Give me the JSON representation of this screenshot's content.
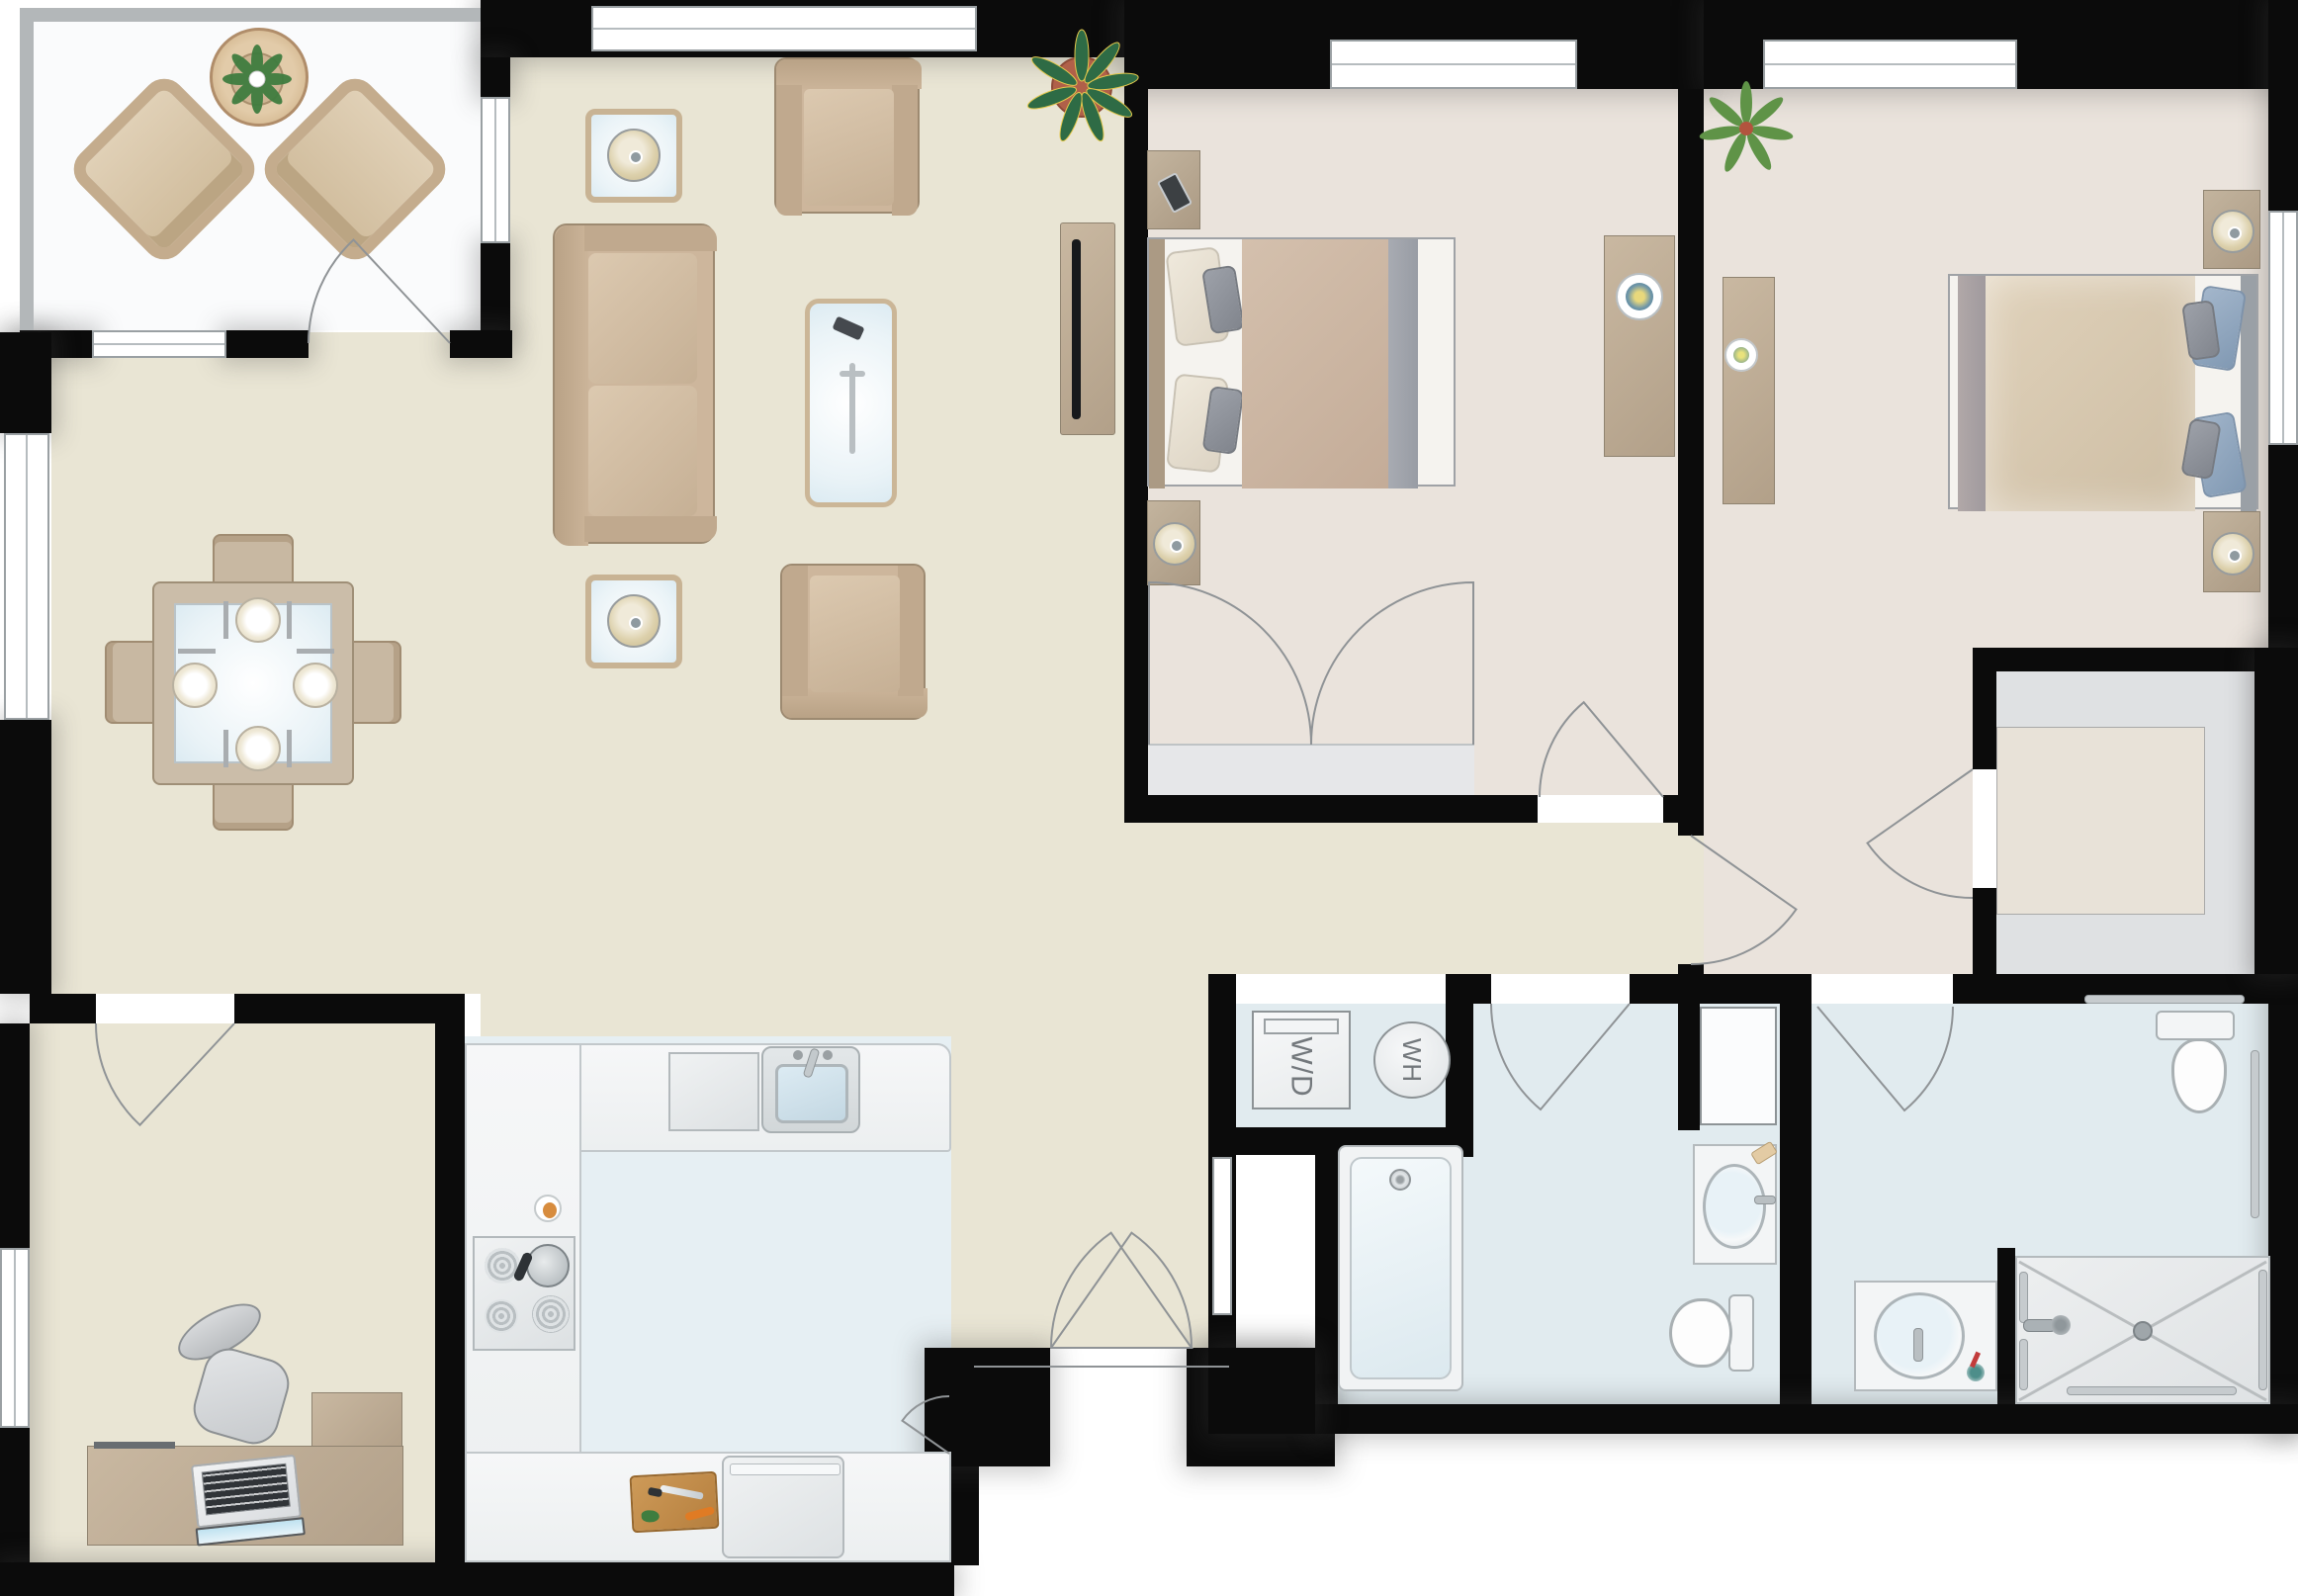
{
  "title": "2-bedroom apartment floor plan",
  "labels": {
    "washer_dryer": "W/D",
    "water_heater": "WH"
  },
  "palette": {
    "wall": "#0b0b0b",
    "living_floor": "#e9e5d4",
    "bedroom_floor": "#eae3dc",
    "bathroom_floor": "#e1ebef",
    "kitchen_floor": "#e6eff3",
    "balcony_floor": "#fafbfc",
    "wood_furniture": "#b9a88f",
    "glass": "#eaf3f7",
    "door_arc": "#8f9396",
    "label_text": "#73787c"
  },
  "rooms": [
    {
      "name": "balcony",
      "furniture": [
        "wicker-armchair",
        "wicker-armchair",
        "round-table",
        "potted-plant",
        "door-swing"
      ]
    },
    {
      "name": "living-room",
      "furniture": [
        "sofa",
        "armchair",
        "armchair",
        "coffee-table",
        "side-table-lamp",
        "side-table-lamp",
        "tv-console",
        "flat-tv",
        "potted-plant"
      ]
    },
    {
      "name": "dining-area",
      "furniture": [
        "square-glass-table",
        "dining-chair",
        "dining-chair",
        "dining-chair",
        "dining-chair",
        "place-setting",
        "place-setting",
        "place-setting",
        "place-setting"
      ]
    },
    {
      "name": "bedroom-1",
      "furniture": [
        "queen-bed",
        "nightstand-phone",
        "nightstand-lamp",
        "dresser-lamp",
        "closet-double-doors",
        "window"
      ]
    },
    {
      "name": "bedroom-2",
      "furniture": [
        "queen-bed",
        "nightstand-lamp",
        "nightstand-lamp",
        "dresser-candle",
        "potted-plant",
        "window",
        "walk-in-closet"
      ]
    },
    {
      "name": "kitchen",
      "furniture": [
        "sink",
        "dishwasher",
        "stove-4-burners",
        "kettle",
        "refrigerator",
        "cutting-board",
        "egg-plate",
        "pantry-door"
      ]
    },
    {
      "name": "office",
      "furniture": [
        "l-shaped-desk",
        "laptop",
        "office-chair",
        "window"
      ]
    },
    {
      "name": "laundry-closet",
      "furniture": [
        "washer-dryer",
        "water-heater"
      ]
    },
    {
      "name": "hall-bathroom",
      "furniture": [
        "bathtub",
        "vanity-sink",
        "toilet",
        "linen-closet",
        "door-swing"
      ]
    },
    {
      "name": "master-bathroom",
      "furniture": [
        "walk-in-shower",
        "vanity-sink",
        "toilet",
        "grab-bars",
        "door-swing"
      ]
    }
  ]
}
